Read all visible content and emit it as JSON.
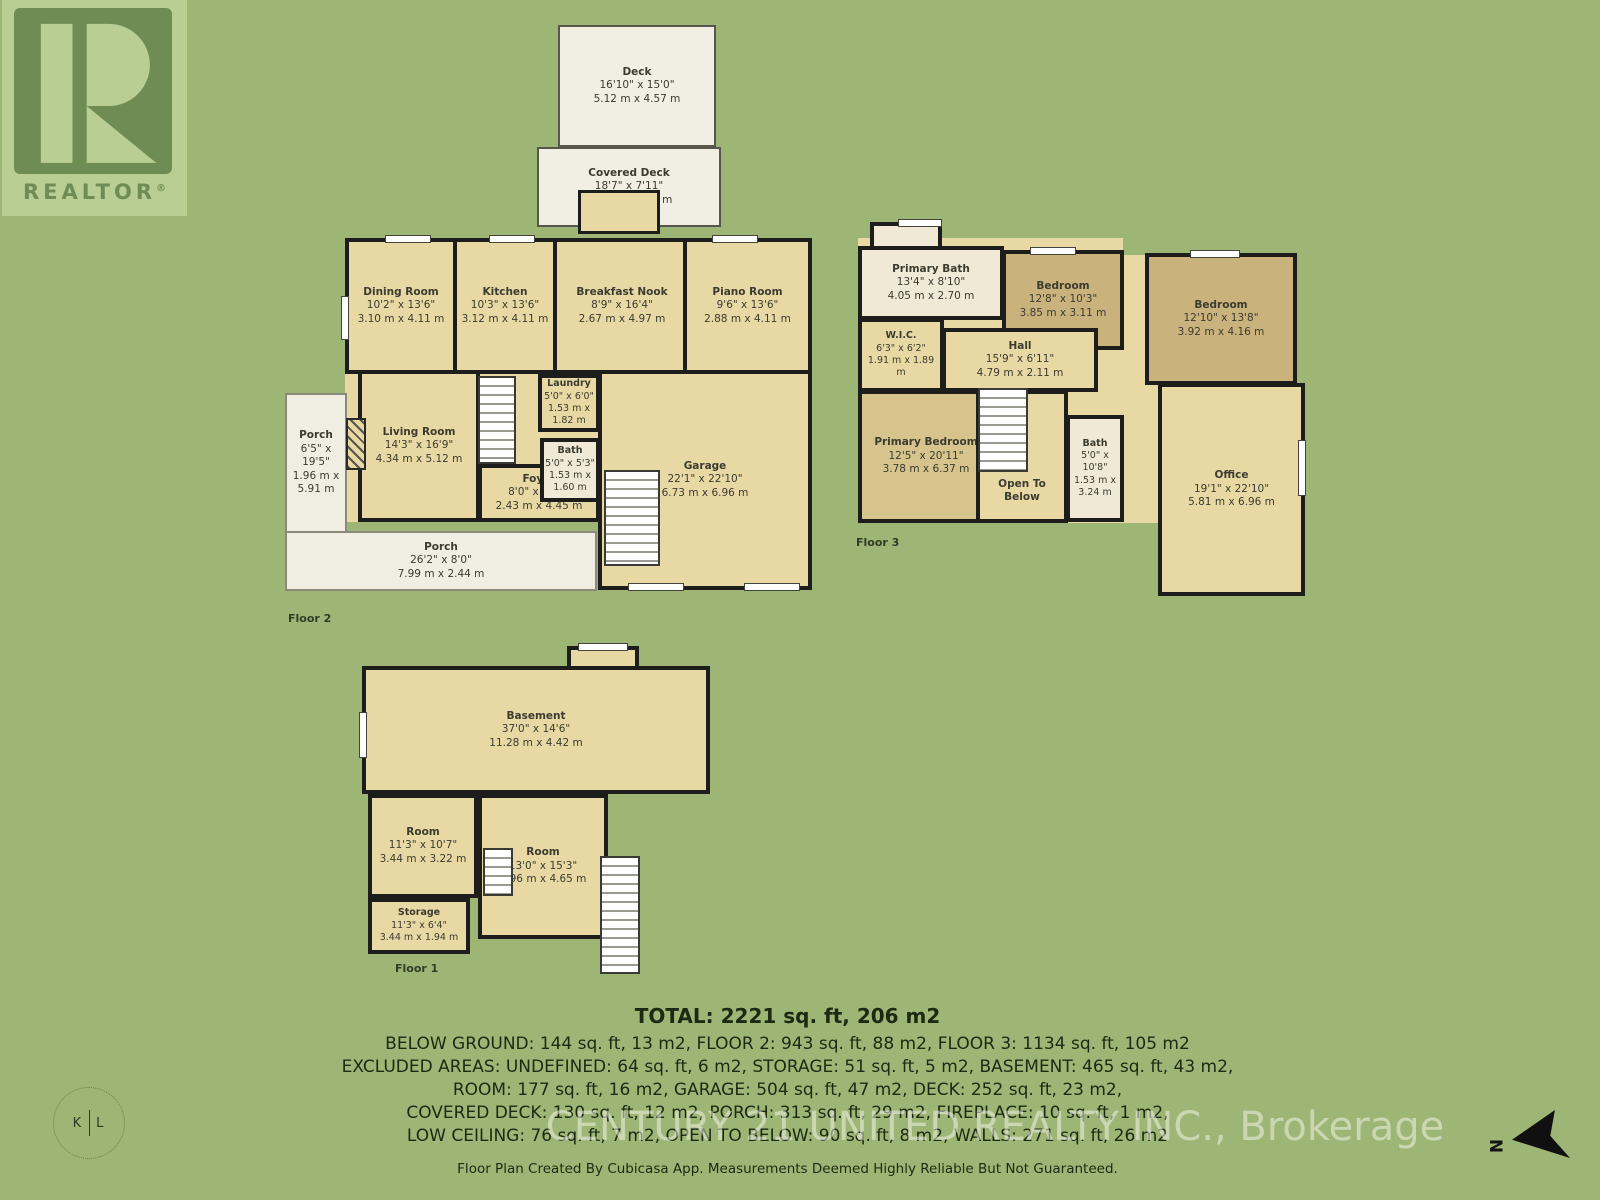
{
  "badge": {
    "label": "REALTOR",
    "reg": "®"
  },
  "photo": {
    "left": "K",
    "right": "L"
  },
  "compass": {
    "letter": "N"
  },
  "colors": {
    "background": "#9db575",
    "wall": "#1d1d1b",
    "room_tan": "#e8d8a4",
    "room_khaki": "#c9b27c",
    "room_cream": "#f0e9d6",
    "porch": "#f0ede2"
  },
  "floor2": {
    "label": "Floor 2",
    "rooms": {
      "deck": {
        "name": "Deck",
        "ft": "16'10\" x 15'0\"",
        "m": "5.12 m x 4.57 m"
      },
      "covered_deck": {
        "name": "Covered Deck",
        "ft": "18'7\" x 7'11\"",
        "m": "5.67 m x 2.42 m"
      },
      "dining": {
        "name": "Dining Room",
        "ft": "10'2\" x 13'6\"",
        "m": "3.10 m x 4.11 m"
      },
      "kitchen": {
        "name": "Kitchen",
        "ft": "10'3\" x 13'6\"",
        "m": "3.12 m x 4.11 m"
      },
      "breakfast": {
        "name": "Breakfast Nook",
        "ft": "8'9\" x 16'4\"",
        "m": "2.67 m x 4.97 m"
      },
      "piano": {
        "name": "Piano Room",
        "ft": "9'6\" x 13'6\"",
        "m": "2.88 m x 4.11 m"
      },
      "living": {
        "name": "Living Room",
        "ft": "14'3\" x 16'9\"",
        "m": "4.34 m x 5.12 m"
      },
      "foyer": {
        "name": "Foyer",
        "ft": "8'0\" x 14'7\"",
        "m": "2.43 m x 4.45 m"
      },
      "laundry": {
        "name": "Laundry",
        "ft": "5'0\" x 6'0\"",
        "m": "1.53 m x 1.82 m"
      },
      "bath": {
        "name": "Bath",
        "ft": "5'0\" x 5'3\"",
        "m": "1.53 m x 1.60 m"
      },
      "garage": {
        "name": "Garage",
        "ft": "22'1\" x 22'10\"",
        "m": "6.73 m x 6.96 m"
      },
      "porch_side": {
        "name": "Porch",
        "ft": "6'5\" x 19'5\"",
        "m": "1.96 m x 5.91 m"
      },
      "porch_front": {
        "name": "Porch",
        "ft": "26'2\" x 8'0\"",
        "m": "7.99 m x 2.44 m"
      }
    }
  },
  "floor3": {
    "label": "Floor 3",
    "rooms": {
      "primary_bath": {
        "name": "Primary Bath",
        "ft": "13'4\" x 8'10\"",
        "m": "4.05 m x 2.70 m"
      },
      "bedroom_a": {
        "name": "Bedroom",
        "ft": "12'8\" x 10'3\"",
        "m": "3.85 m x 3.11 m"
      },
      "bedroom_b": {
        "name": "Bedroom",
        "ft": "12'10\" x 13'8\"",
        "m": "3.92 m x 4.16 m"
      },
      "wic": {
        "name": "W.I.C.",
        "ft": "6'3\" x 6'2\"",
        "m": "1.91 m x 1.89 m"
      },
      "hall": {
        "name": "Hall",
        "ft": "15'9\" x 6'11\"",
        "m": "4.79 m x 2.11 m"
      },
      "primary_bedroom": {
        "name": "Primary Bedroom",
        "ft": "12'5\" x 20'11\"",
        "m": "3.78 m x 6.37 m"
      },
      "open_below": {
        "name": "Open To Below"
      },
      "bath": {
        "name": "Bath",
        "ft": "5'0\" x 10'8\"",
        "m": "1.53 m x 3.24 m"
      },
      "office": {
        "name": "Office",
        "ft": "19'1\" x 22'10\"",
        "m": "5.81 m x 6.96 m"
      }
    }
  },
  "floor1": {
    "label": "Floor 1",
    "rooms": {
      "basement": {
        "name": "Basement",
        "ft": "37'0\" x 14'6\"",
        "m": "11.28 m x 4.42 m"
      },
      "room_a": {
        "name": "Room",
        "ft": "11'3\" x 10'7\"",
        "m": "3.44 m x 3.22 m"
      },
      "room_b": {
        "name": "Room",
        "ft": "13'0\" x 15'3\"",
        "m": "3.96 m x 4.65 m"
      },
      "storage": {
        "name": "Storage",
        "ft": "11'3\" x 6'4\"",
        "m": "3.44 m x 1.94 m"
      }
    }
  },
  "footer": {
    "total": "TOTAL: 2221 sq. ft, 206 m2",
    "lines": [
      "BELOW GROUND: 144 sq. ft, 13 m2, FLOOR 2: 943 sq. ft, 88 m2, FLOOR 3: 1134 sq. ft, 105 m2",
      "EXCLUDED AREAS: UNDEFINED: 64 sq. ft, 6 m2, STORAGE: 51 sq. ft, 5 m2, BASEMENT: 465 sq. ft, 43 m2,",
      "ROOM: 177 sq. ft, 16 m2, GARAGE: 504 sq. ft, 47 m2, DECK: 252 sq. ft, 23 m2,",
      "COVERED DECK: 130 sq. ft, 12 m2, PORCH: 313 sq. ft, 29 m2, FIREPLACE: 10 sq. ft, 1 m2,",
      "LOW CEILING: 76 sq. ft, 7 m2, OPEN TO BELOW: 90 sq. ft, 8 m2, WALLS: 271 sq. ft, 26 m2"
    ],
    "watermark": "CENTURY 21 UNITED REALTY INC., Brokerage",
    "disclaimer": "Floor Plan Created By Cubicasa App. Measurements Deemed Highly Reliable But Not Guaranteed."
  }
}
